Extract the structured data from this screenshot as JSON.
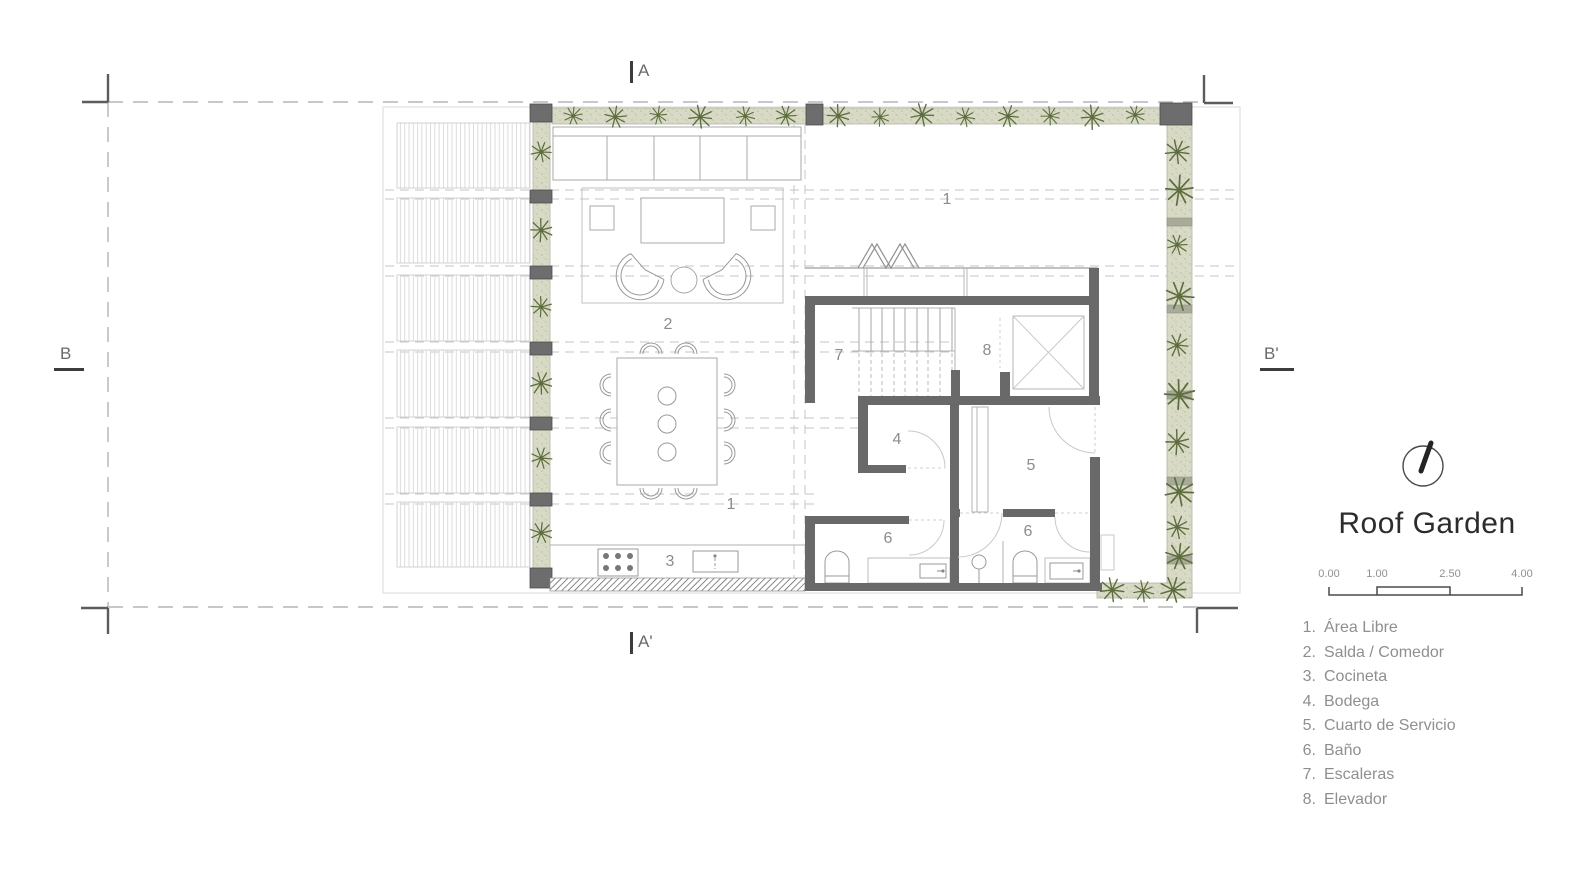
{
  "title": "Roof Garden",
  "section_markers": {
    "top": "A",
    "bottom": "A'",
    "left": "B",
    "right": "B'"
  },
  "plan_labels": {
    "terrace": "1",
    "living": "2",
    "living_secondary": "1",
    "kitchen": "3",
    "storage": "4",
    "service_room": "5",
    "bath_left": "6",
    "bath_right": "6",
    "stairs": "7",
    "elevator": "8"
  },
  "scale_bar": {
    "ticks": [
      "0.00",
      "1.00",
      "2.50",
      "4.00"
    ]
  },
  "legend": {
    "items": [
      {
        "number": "1.",
        "label": "Área Libre"
      },
      {
        "number": "2.",
        "label": "Salda / Comedor"
      },
      {
        "number": "3.",
        "label": "Cocineta"
      },
      {
        "number": "4.",
        "label": "Bodega"
      },
      {
        "number": "5.",
        "label": "Cuarto de Servicio"
      },
      {
        "number": "6.",
        "label": "Baño"
      },
      {
        "number": "7.",
        "label": "Escaleras"
      },
      {
        "number": "8.",
        "label": "Elevador"
      }
    ]
  },
  "colors": {
    "wall": "#696969",
    "plant": "#5d6d3e",
    "planter_bg": "#d8dac6",
    "label": "#8c8c8c",
    "light_line": "#c9c9c9",
    "title": "#2c2c2c"
  }
}
